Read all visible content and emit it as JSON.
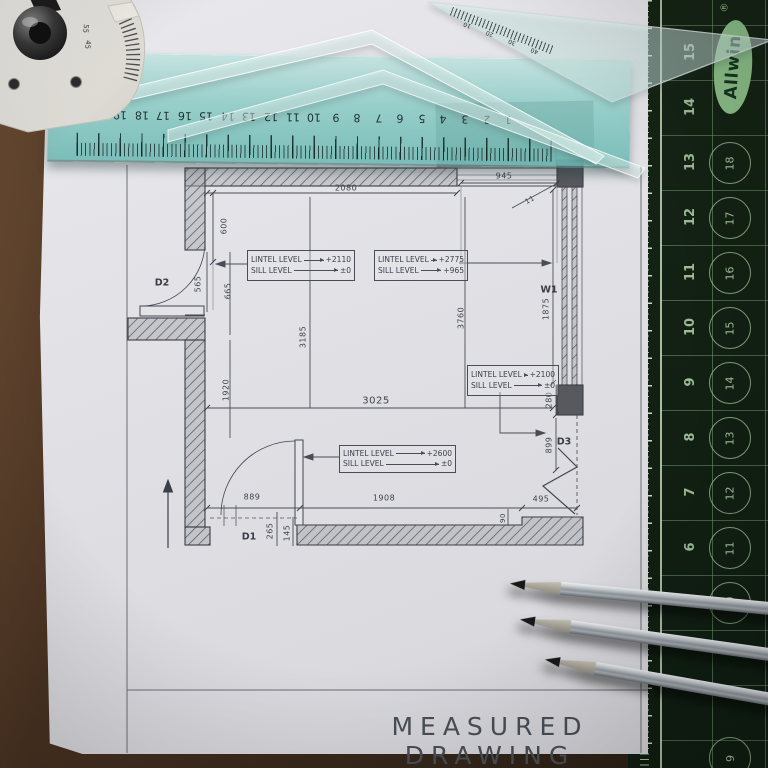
{
  "title_block": {
    "title": "MEASURED DRAWING"
  },
  "plan": {
    "dims": {
      "top_width": "2080",
      "top_window": "945",
      "corner_depth": "50",
      "left_top": "600",
      "d2_width": "565",
      "left_mid": "665",
      "left_lower": "1920",
      "room_left": "3185",
      "room_right": "3760",
      "room_width": "3025",
      "w1_height": "1875",
      "block_height": "280",
      "d3_offset": "899",
      "bottom_left": "889",
      "bottom_mid": "1908",
      "bottom_right": "495",
      "d1_a": "265",
      "d1_b": "145",
      "step": "90",
      "pane": "11"
    },
    "openings": {
      "d1": "D1",
      "d2": "D2",
      "d3": "D3",
      "w1": "W1"
    },
    "levels": [
      {
        "label1": "LINTEL LEVEL",
        "value1": "+2110",
        "label2": "SILL LEVEL",
        "value2": "±0"
      },
      {
        "label1": "LINTEL LEVEL",
        "value1": "+2775",
        "label2": "SILL LEVEL",
        "value2": "+965"
      },
      {
        "label1": "LINTEL LEVEL",
        "value1": "+2100",
        "label2": "SILL LEVEL",
        "value2": "±0"
      },
      {
        "label1": "LINTEL LEVEL",
        "value1": "+2600",
        "label2": "SILL LEVEL",
        "value2": "±0"
      }
    ]
  },
  "ruler": {
    "numbers": [
      "21",
      "20",
      "19",
      "18",
      "17",
      "16",
      "15",
      "14",
      "13",
      "12",
      "11",
      "10",
      "9",
      "8",
      "7",
      "6",
      "5",
      "4",
      "3",
      "2",
      "1"
    ]
  },
  "mat": {
    "brand": "Allwin",
    "registered": "®",
    "scale_numbers": [
      "15",
      "14",
      "13",
      "12",
      "11",
      "10",
      "9",
      "8",
      "7",
      "6",
      "5"
    ],
    "circle_numbers": [
      "18",
      "17",
      "16",
      "15",
      "14",
      "13",
      "12",
      "11",
      "10",
      "9"
    ]
  },
  "set_square": {
    "scale": [
      "10",
      "20",
      "30",
      "40"
    ]
  },
  "protractor": {
    "angles": [
      "55",
      "45"
    ]
  },
  "colors": {
    "mat_green": "#132214",
    "mat_lines": "#7ea57a",
    "paper": "#e1e1e5",
    "ruler_teal": "#7cc4bd",
    "board_brown": "#4a3322",
    "pencil_line": "#42454d",
    "allwin_green": "#8cbf88"
  }
}
